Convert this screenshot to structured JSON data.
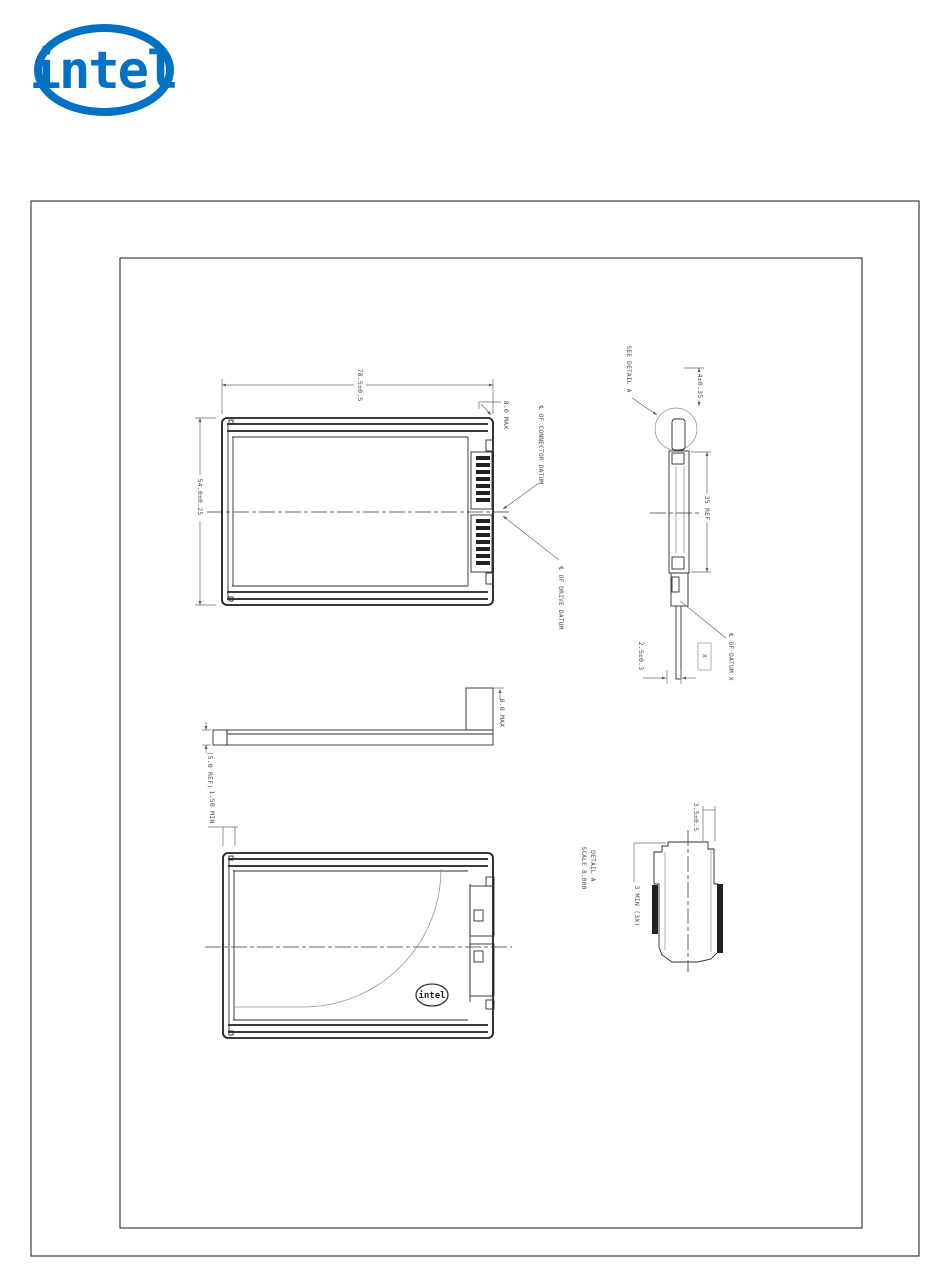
{
  "logo": {
    "brand": "intel",
    "registered": "®",
    "color": "#0071c5"
  },
  "drawing": {
    "top_view": {
      "dim_length": "78.5±0.5",
      "dim_width": "54.0±0.25",
      "dim_corner": "8.0 MAX",
      "label_connector_datum": "℄ OF CONNECTOR DATUM",
      "label_drive_datum": "℄ OF DRIVE DATUM"
    },
    "side_view": {
      "dim_height": "(5.0 REF)",
      "dim_step": "8.0 MAX"
    },
    "bottom_view": {
      "dim_rail": "1.50 MIN",
      "logo_text": "intel"
    },
    "end_view": {
      "label_see_detail": "SEE DETAIL A",
      "dim_top": "4±0.35",
      "dim_span": "35 REF",
      "dim_bottom": "2.5±0.3",
      "datum_flag": "X",
      "label_datum": "℄ OF DATUM X"
    },
    "detail_a": {
      "title": "DETAIL A",
      "scale": "SCALE 8.000",
      "dim_width": "3.5±0.5",
      "dim_min": "3 MIN (3X)"
    }
  }
}
